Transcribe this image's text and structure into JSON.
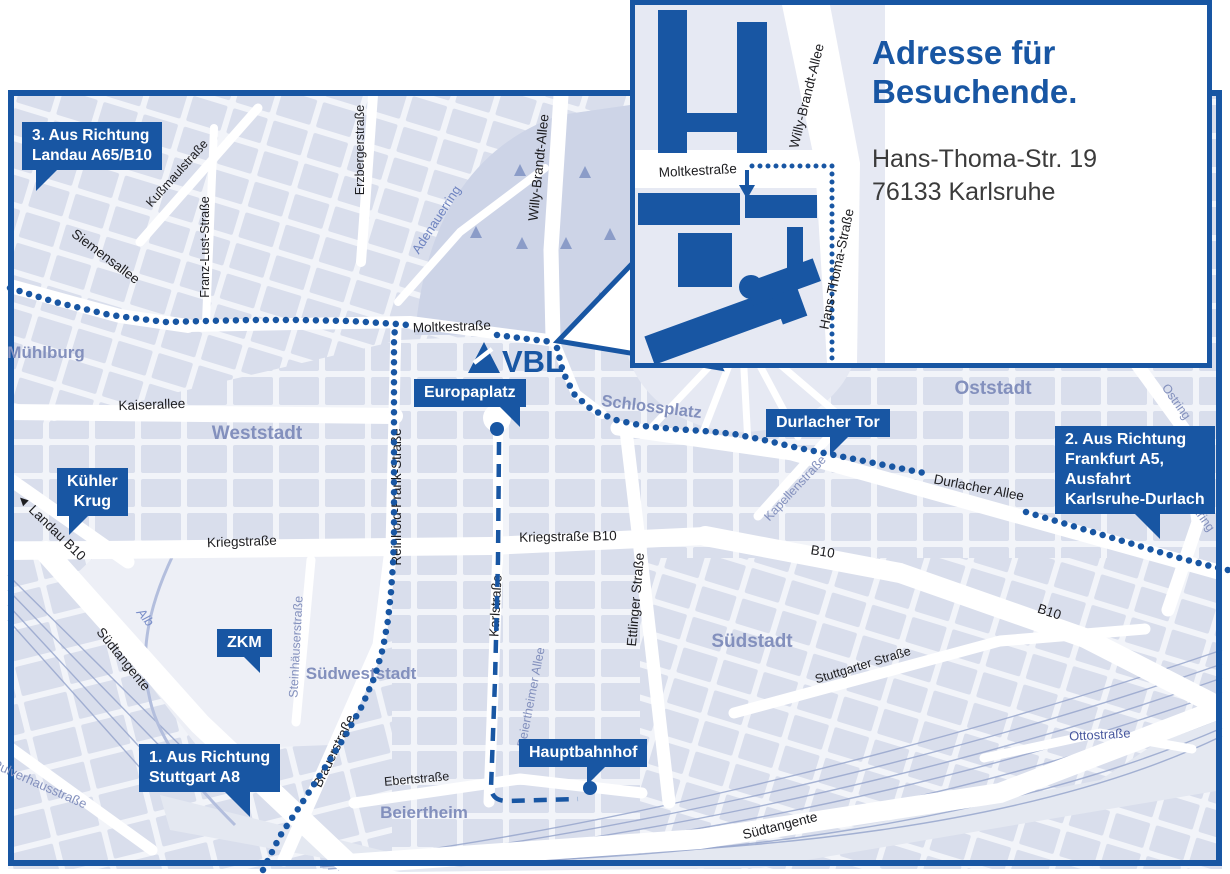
{
  "colors": {
    "accent": "#1856A3",
    "mapbg": "#EDEFF6",
    "block": "#D9DEEC",
    "blockbg": "#F2F4F9",
    "park": "#CDD4E7",
    "plaza": "#E6E9F3",
    "railband": "#E4E8F1",
    "railline": "#97A6CC",
    "street_dark": "#1D1D20",
    "label_blue": "#8390BD",
    "label_navy": "#47579E",
    "water": "#7B8FC9",
    "text_dark": "#3B3B3B"
  },
  "logo": {
    "text": "VBL"
  },
  "inset": {
    "title_line1": "Adresse für",
    "title_line2": "Besuchende.",
    "address_line1": "Hans-Thoma-Str. 19",
    "address_line2": "76133 Karlsruhe",
    "streets": {
      "moltkestrasse": "Moltkestraße",
      "willy_brandt_allee": "Willy-Brandt-Allee",
      "hans_thoma_strasse": "Hans-Thoma-Straße"
    }
  },
  "callouts": {
    "landau": {
      "lines": [
        "3. Aus Richtung",
        "Landau A65/B10"
      ]
    },
    "frankfurt": {
      "lines": [
        "2. Aus Richtung",
        "Frankfurt A5,",
        "Ausfahrt",
        "Karlsruhe-Durlach"
      ]
    },
    "stuttgart": {
      "lines": [
        "1. Aus Richtung",
        "Stuttgart A8"
      ]
    },
    "kuehler_krug": {
      "lines": [
        "Kühler",
        "Krug"
      ]
    },
    "zkm": {
      "label": "ZKM"
    },
    "europaplatz": {
      "label": "Europaplatz"
    },
    "durlacher_tor": {
      "label": "Durlacher Tor"
    },
    "hauptbahnhof": {
      "label": "Hauptbahnhof"
    }
  },
  "streets": {
    "moltkestrasse_main": "Moltkestraße",
    "siemensallee": "Siemensallee",
    "kussmaulstrasse": "Kußmaulstraße",
    "franz_lust_strasse": "Franz-Lust-Straße",
    "erzbergerstrasse": "Erzbergerstraße",
    "willy_brandt_allee": "Willy-Brandt-Allee",
    "adenauerring": "Adenauerring",
    "kaiserallee": "Kaiserallee",
    "reinhold_frank_strasse": "Reinhold-Frank-Straße",
    "kriegstrasse": "Kriegstraße",
    "kriegstrasse_b10": "Kriegstraße B10",
    "karlstrasse": "Karlstraße",
    "ettlinger_strasse": "Ettlinger Straße",
    "durlacher_allee": "Durlacher Allee",
    "b10_west": "B10",
    "b10_east": "B10",
    "landau_arrow": "◄",
    "landau_b10": "Landau B10",
    "suedtangente_west": "Südtangente",
    "suedtangente_sued": "Südtangente",
    "steinhaeuserstrasse": "Steinhäuserstraße",
    "brauerstrasse": "Brauerstraße",
    "ebertstrasse": "Ebertstraße",
    "stuttgarter_strasse": "Stuttgarter Straße",
    "kapellenstrasse": "Kapellenstraße",
    "ostring_nord": "Ostring",
    "ostring_sued": "Ostring",
    "ottostrasse": "Ottostraße",
    "pulverhausstrasse": "Pulverhausstraße",
    "beiertheimer_allee": "Beiertheimer Allee",
    "alb": "Alb"
  },
  "areas": {
    "muehlburg": "Mühlburg",
    "weststadt": "Weststadt",
    "oststadt": "Oststadt",
    "schlossplatz": "Schlossplatz",
    "suedstadt": "Südstadt",
    "suedweststadt": "Südweststadt",
    "beiertheim": "Beiertheim"
  }
}
